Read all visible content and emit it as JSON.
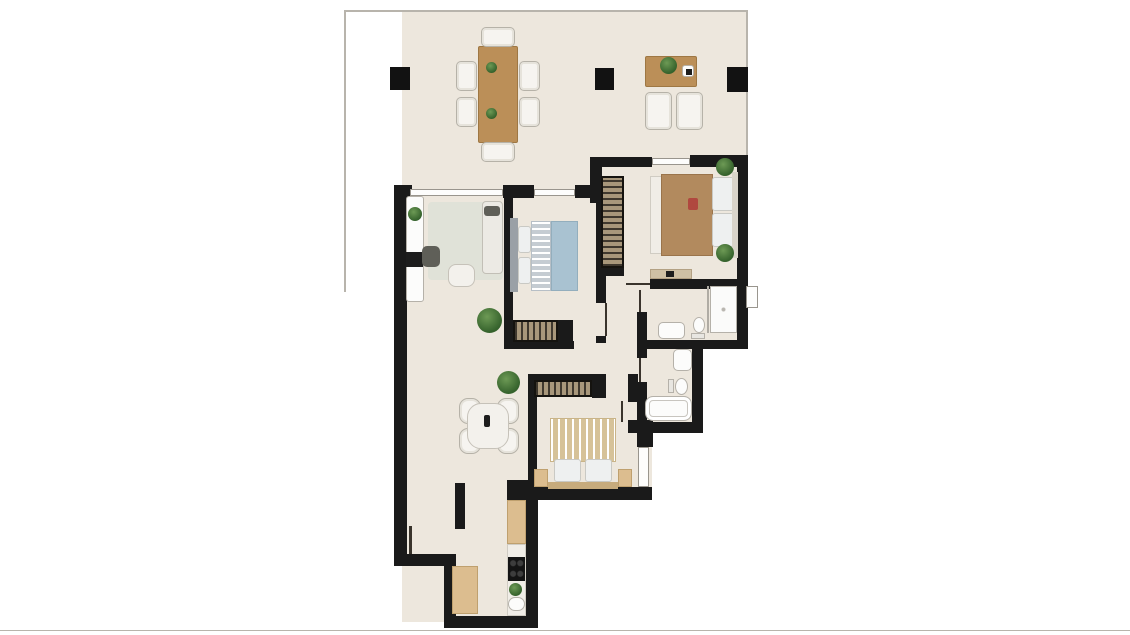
{
  "meta": {
    "type": "apartment-floorplan",
    "description": "Rendered 2-bedroom apartment floor plan with large top terrace, living room, two bedrooms, two bathrooms and galley kitchen. No text labels visible."
  },
  "palette": {
    "background": "#ffffff",
    "floor": "#ede7dd",
    "wall": "#1a1a1a",
    "wood": "#bb8f58",
    "plant_green": "#456f36",
    "bed_blue": "#a9c2d1",
    "bed_tan": "#b28a5e",
    "stripe_tan": "#d6c298"
  },
  "floorplan": {
    "floors": [
      {
        "name": "floor-terrace-left",
        "x": 402,
        "y": 12,
        "w": 200,
        "h": 176
      },
      {
        "name": "floor-terrace-right",
        "x": 602,
        "y": 12,
        "w": 146,
        "h": 146
      },
      {
        "name": "floor-living-kitchen",
        "x": 402,
        "y": 188,
        "w": 134,
        "h": 434
      },
      {
        "name": "floor-bedroom1-zone",
        "x": 505,
        "y": 188,
        "w": 100,
        "h": 305
      },
      {
        "name": "floor-hallway",
        "x": 596,
        "y": 197,
        "w": 41,
        "h": 290
      },
      {
        "name": "floor-master-bedroom",
        "x": 600,
        "y": 158,
        "w": 148,
        "h": 131
      },
      {
        "name": "floor-bathroom1",
        "x": 637,
        "y": 279,
        "w": 111,
        "h": 70
      },
      {
        "name": "floor-bathroom2",
        "x": 600,
        "y": 289,
        "w": 103,
        "h": 144
      },
      {
        "name": "floor-bedroom2-east",
        "x": 628,
        "y": 420,
        "w": 24,
        "h": 70
      }
    ],
    "boundary_lines": [
      {
        "name": "terrace-edge-top",
        "x": 344,
        "y": 10,
        "w": 404,
        "h": 2
      },
      {
        "name": "terrace-edge-left",
        "x": 344,
        "y": 10,
        "w": 2,
        "h": 282
      },
      {
        "name": "terrace-edge-right",
        "x": 746,
        "y": 10,
        "w": 2,
        "h": 148
      },
      {
        "name": "image-bottom-edge",
        "x": 0,
        "y": 630,
        "w": 1130,
        "h": 1
      }
    ],
    "pillars": [
      {
        "name": "pillar-terrace-left",
        "x": 390,
        "y": 67,
        "w": 20,
        "h": 23
      },
      {
        "name": "pillar-terrace-middle",
        "x": 595,
        "y": 68,
        "w": 19,
        "h": 22
      },
      {
        "name": "pillar-terrace-right",
        "x": 727,
        "y": 67,
        "w": 21,
        "h": 25
      }
    ],
    "walls": [
      {
        "name": "wall-exterior-left",
        "x": 394,
        "y": 185,
        "w": 13,
        "h": 381
      },
      {
        "name": "wall-step-bottom-left",
        "x": 394,
        "y": 554,
        "w": 62,
        "h": 12
      },
      {
        "name": "wall-kitchen-left",
        "x": 444,
        "y": 566,
        "w": 12,
        "h": 62
      },
      {
        "name": "wall-kitchen-bottom",
        "x": 444,
        "y": 616,
        "w": 94,
        "h": 12
      },
      {
        "name": "wall-kitchen-right",
        "x": 526,
        "y": 497,
        "w": 12,
        "h": 131
      },
      {
        "name": "wall-bedroom2-corner-block",
        "x": 507,
        "y": 480,
        "w": 21,
        "h": 20
      },
      {
        "name": "wall-bedroom2-bottom",
        "x": 522,
        "y": 487,
        "w": 130,
        "h": 13
      },
      {
        "name": "wall-se-step",
        "x": 637,
        "y": 420,
        "w": 16,
        "h": 27
      },
      {
        "name": "wall-bath2-bottom",
        "x": 637,
        "y": 422,
        "w": 66,
        "h": 11
      },
      {
        "name": "wall-bath2-right",
        "x": 692,
        "y": 340,
        "w": 11,
        "h": 93
      },
      {
        "name": "wall-bath-divider",
        "x": 637,
        "y": 340,
        "w": 111,
        "h": 9
      },
      {
        "name": "wall-exterior-right",
        "x": 737,
        "y": 155,
        "w": 11,
        "h": 194
      },
      {
        "name": "wall-master-top-right",
        "x": 690,
        "y": 155,
        "w": 58,
        "h": 12
      },
      {
        "name": "wall-master-top-left",
        "x": 590,
        "y": 157,
        "w": 62,
        "h": 10
      },
      {
        "name": "wall-terrace-step",
        "x": 590,
        "y": 157,
        "w": 12,
        "h": 46
      },
      {
        "name": "wall-living-top-corner",
        "x": 394,
        "y": 185,
        "w": 18,
        "h": 13
      },
      {
        "name": "wall-north-mid",
        "x": 503,
        "y": 185,
        "w": 31,
        "h": 13
      },
      {
        "name": "wall-north-right",
        "x": 575,
        "y": 185,
        "w": 27,
        "h": 13
      },
      {
        "name": "wall-bedroom1-left",
        "x": 504,
        "y": 187,
        "w": 9,
        "h": 160
      },
      {
        "name": "wall-bedroom1-bottom",
        "x": 504,
        "y": 341,
        "w": 70,
        "h": 8
      },
      {
        "name": "wall-bedroom1-wardrobe-cap",
        "x": 557,
        "y": 320,
        "w": 16,
        "h": 22
      },
      {
        "name": "wall-bedroom1-right",
        "x": 596,
        "y": 197,
        "w": 10,
        "h": 106
      },
      {
        "name": "wall-bedroom1-door-jamb",
        "x": 596,
        "y": 336,
        "w": 10,
        "h": 7
      },
      {
        "name": "wall-master-wardrobe-stub",
        "x": 600,
        "y": 267,
        "w": 24,
        "h": 9
      },
      {
        "name": "wall-master-bottom",
        "x": 650,
        "y": 279,
        "w": 98,
        "h": 10
      },
      {
        "name": "wall-bath1-left",
        "x": 637,
        "y": 312,
        "w": 10,
        "h": 28
      },
      {
        "name": "wall-bath2-left-stub",
        "x": 637,
        "y": 348,
        "w": 10,
        "h": 10
      },
      {
        "name": "wall-bath2-left",
        "x": 637,
        "y": 382,
        "w": 10,
        "h": 40
      },
      {
        "name": "wall-bedroom2-top",
        "x": 528,
        "y": 374,
        "w": 78,
        "h": 7
      },
      {
        "name": "wall-bedroom2-wardrobe-cap",
        "x": 592,
        "y": 374,
        "w": 14,
        "h": 24
      },
      {
        "name": "wall-bedroom2-left",
        "x": 528,
        "y": 374,
        "w": 9,
        "h": 119
      },
      {
        "name": "wall-bedroom2-right",
        "x": 628,
        "y": 374,
        "w": 10,
        "h": 28
      },
      {
        "name": "wall-bedroom2-right-stub",
        "x": 628,
        "y": 420,
        "w": 25,
        "h": 13
      },
      {
        "name": "wall-living-kitchen-partial",
        "x": 455,
        "y": 483,
        "w": 10,
        "h": 46
      }
    ],
    "windows": [
      {
        "name": "window-living-terrace",
        "x": 410,
        "y": 189,
        "w": 93,
        "h": 7
      },
      {
        "name": "window-bedroom1-terrace",
        "x": 534,
        "y": 189,
        "w": 41,
        "h": 7
      },
      {
        "name": "window-master-terrace",
        "x": 652,
        "y": 158,
        "w": 38,
        "h": 7
      },
      {
        "name": "window-shower-east",
        "x": 746,
        "y": 286,
        "w": 12,
        "h": 22
      },
      {
        "name": "window-bedroom2-east",
        "x": 638,
        "y": 447,
        "w": 11,
        "h": 40
      }
    ],
    "doors": [
      {
        "name": "door-bedroom1",
        "x": 605,
        "y": 303,
        "w": 2,
        "h": 33
      },
      {
        "name": "door-master-bedroom",
        "x": 626,
        "y": 283,
        "w": 24,
        "h": 2
      },
      {
        "name": "door-bathroom1",
        "x": 639,
        "y": 290,
        "w": 2,
        "h": 22
      },
      {
        "name": "door-bathroom2",
        "x": 639,
        "y": 358,
        "w": 2,
        "h": 24
      },
      {
        "name": "door-bedroom2",
        "x": 621,
        "y": 401,
        "w": 2,
        "h": 21
      },
      {
        "name": "door-living-west",
        "x": 409,
        "y": 526,
        "w": 3,
        "h": 28
      }
    ],
    "furniture": [
      {
        "name": "terrace-dining-table",
        "kind": "wood",
        "x": 478,
        "y": 46,
        "w": 40,
        "h": 97
      },
      {
        "name": "terrace-chair-top",
        "kind": "chair",
        "x": 481,
        "y": 27,
        "w": 34,
        "h": 20
      },
      {
        "name": "terrace-chair-bottom",
        "kind": "chair",
        "x": 481,
        "y": 142,
        "w": 34,
        "h": 20
      },
      {
        "name": "terrace-chair-left-1",
        "kind": "chair",
        "x": 456,
        "y": 61,
        "w": 21,
        "h": 30
      },
      {
        "name": "terrace-chair-left-2",
        "kind": "chair",
        "x": 456,
        "y": 97,
        "w": 21,
        "h": 30
      },
      {
        "name": "terrace-chair-right-1",
        "kind": "chair",
        "x": 519,
        "y": 61,
        "w": 21,
        "h": 30
      },
      {
        "name": "terrace-chair-right-2",
        "kind": "chair",
        "x": 519,
        "y": 97,
        "w": 21,
        "h": 30
      },
      {
        "name": "terrace-table-plant-1",
        "kind": "plant",
        "x": 486,
        "y": 62,
        "w": 11,
        "h": 11
      },
      {
        "name": "terrace-table-plant-2",
        "kind": "plant",
        "x": 486,
        "y": 108,
        "w": 11,
        "h": 11
      },
      {
        "name": "terrace-coffee-table",
        "kind": "wood",
        "x": 645,
        "y": 56,
        "w": 52,
        "h": 31
      },
      {
        "name": "terrace-coffee-table-plant",
        "kind": "plant",
        "x": 660,
        "y": 57,
        "w": 17,
        "h": 17
      },
      {
        "name": "terrace-coffee-table-tray",
        "kind": "fixture",
        "x": 682,
        "y": 65,
        "w": 12,
        "h": 12
      },
      {
        "name": "terrace-tray-item",
        "kind": "tv",
        "x": 686,
        "y": 69,
        "w": 6,
        "h": 6
      },
      {
        "name": "terrace-armchair-1",
        "kind": "chair",
        "x": 645,
        "y": 92,
        "w": 27,
        "h": 38
      },
      {
        "name": "terrace-armchair-2",
        "kind": "chair",
        "x": 676,
        "y": 92,
        "w": 27,
        "h": 38
      },
      {
        "name": "living-rug",
        "kind": "rug",
        "x": 428,
        "y": 202,
        "w": 75,
        "h": 78
      },
      {
        "name": "living-tv-sideboard",
        "kind": "fixture",
        "x": 406,
        "y": 196,
        "w": 18,
        "h": 106
      },
      {
        "name": "living-sideboard-plant",
        "kind": "plant",
        "x": 408,
        "y": 207,
        "w": 14,
        "h": 14
      },
      {
        "name": "living-tv",
        "kind": "tv",
        "x": 406,
        "y": 252,
        "w": 17,
        "h": 15
      },
      {
        "name": "living-sofa",
        "kind": "sofa",
        "x": 482,
        "y": 201,
        "w": 21,
        "h": 73
      },
      {
        "name": "living-sofa-cushion",
        "kind": "dark",
        "x": 484,
        "y": 206,
        "w": 16,
        "h": 10
      },
      {
        "name": "living-armchair",
        "kind": "dark",
        "x": 422,
        "y": 246,
        "w": 18,
        "h": 21,
        "r": 5
      },
      {
        "name": "living-coffee-table",
        "kind": "table-light",
        "x": 448,
        "y": 264,
        "w": 27,
        "h": 23
      },
      {
        "name": "living-plant",
        "kind": "plant",
        "x": 477,
        "y": 308,
        "w": 25,
        "h": 25
      },
      {
        "name": "dining-chair-1",
        "kind": "chair",
        "x": 459,
        "y": 398,
        "w": 22,
        "h": 26,
        "r": 9
      },
      {
        "name": "dining-chair-2",
        "kind": "chair",
        "x": 459,
        "y": 428,
        "w": 22,
        "h": 26,
        "r": 9
      },
      {
        "name": "dining-chair-3",
        "kind": "chair",
        "x": 497,
        "y": 398,
        "w": 22,
        "h": 26,
        "r": 9
      },
      {
        "name": "dining-chair-4",
        "kind": "chair",
        "x": 497,
        "y": 428,
        "w": 22,
        "h": 26,
        "r": 9
      },
      {
        "name": "dining-table",
        "kind": "table-light",
        "x": 467,
        "y": 403,
        "w": 42,
        "h": 46,
        "r": 14
      },
      {
        "name": "dining-table-decor",
        "kind": "tv",
        "x": 484,
        "y": 415,
        "w": 6,
        "h": 12,
        "r": 2
      },
      {
        "name": "dining-plant",
        "kind": "plant",
        "x": 497,
        "y": 371,
        "w": 23,
        "h": 23
      },
      {
        "name": "bedroom1-headboard",
        "kind": "hb",
        "x": 510,
        "y": 218,
        "w": 8,
        "h": 74
      },
      {
        "name": "bedroom1-pillow-1",
        "kind": "pillow",
        "x": 518,
        "y": 226,
        "w": 13,
        "h": 27
      },
      {
        "name": "bedroom1-pillow-2",
        "kind": "pillow",
        "x": 518,
        "y": 257,
        "w": 13,
        "h": 27
      },
      {
        "name": "bedroom1-bed-fold",
        "kind": "stripe-h",
        "x": 531,
        "y": 221,
        "w": 20,
        "h": 70
      },
      {
        "name": "bedroom1-duvet",
        "kind": "duvet-blue",
        "x": 551,
        "y": 221,
        "w": 27,
        "h": 70
      },
      {
        "name": "bedroom1-wardrobe",
        "kind": "wardrobe-h",
        "x": 513,
        "y": 320,
        "w": 45,
        "h": 22
      },
      {
        "name": "master-wardrobe",
        "kind": "wardrobe-v",
        "x": 601,
        "y": 176,
        "w": 23,
        "h": 92
      },
      {
        "name": "master-bed-foot-throw",
        "kind": "white",
        "x": 650,
        "y": 176,
        "w": 12,
        "h": 78
      },
      {
        "name": "master-duvet",
        "kind": "duvet-tan",
        "x": 661,
        "y": 174,
        "w": 52,
        "h": 82
      },
      {
        "name": "master-pillow-1",
        "kind": "pillow",
        "x": 712,
        "y": 177,
        "w": 22,
        "h": 34
      },
      {
        "name": "master-pillow-2",
        "kind": "pillow",
        "x": 712,
        "y": 213,
        "w": 22,
        "h": 34
      },
      {
        "name": "master-headboard",
        "kind": "hb",
        "x": 732,
        "y": 172,
        "w": 6,
        "h": 86,
        "fill": "#d9d4ca"
      },
      {
        "name": "master-nightstand-plant-1",
        "kind": "plant",
        "x": 716,
        "y": 158,
        "w": 18,
        "h": 18
      },
      {
        "name": "master-nightstand-plant-2",
        "kind": "plant",
        "x": 716,
        "y": 244,
        "w": 18,
        "h": 18
      },
      {
        "name": "master-accent-pillow",
        "kind": "accent-red",
        "x": 688,
        "y": 198,
        "w": 10,
        "h": 12
      },
      {
        "name": "master-console",
        "kind": "console",
        "x": 650,
        "y": 269,
        "w": 42,
        "h": 10
      },
      {
        "name": "master-console-decor",
        "kind": "tv",
        "x": 666,
        "y": 271,
        "w": 8,
        "h": 6
      },
      {
        "name": "bath1-shower-glass",
        "kind": "glass",
        "x": 707,
        "y": 286,
        "w": 2,
        "h": 47
      },
      {
        "name": "bath1-shower-tray",
        "kind": "shower",
        "x": 710,
        "y": 286,
        "w": 27,
        "h": 47
      },
      {
        "name": "bath1-sink",
        "kind": "fixture",
        "x": 658,
        "y": 322,
        "w": 27,
        "h": 17,
        "r": 5
      },
      {
        "name": "bath1-toilet-tank",
        "kind": "tank",
        "x": 691,
        "y": 333,
        "w": 14,
        "h": 6
      },
      {
        "name": "bath1-toilet-bowl",
        "kind": "toilet",
        "x": 693,
        "y": 317,
        "w": 12,
        "h": 16
      },
      {
        "name": "bath2-sink",
        "kind": "fixture",
        "x": 673,
        "y": 349,
        "w": 19,
        "h": 22,
        "r": 5
      },
      {
        "name": "bath2-toilet-tank",
        "kind": "tank",
        "x": 668,
        "y": 379,
        "w": 6,
        "h": 14
      },
      {
        "name": "bath2-toilet-bowl",
        "kind": "toilet",
        "x": 675,
        "y": 378,
        "w": 13,
        "h": 17
      },
      {
        "name": "bath2-bathtub",
        "kind": "tub",
        "x": 645,
        "y": 396,
        "w": 47,
        "h": 25
      },
      {
        "name": "bedroom2-duvet",
        "kind": "stripe-v",
        "x": 550,
        "y": 418,
        "w": 66,
        "h": 44
      },
      {
        "name": "bedroom2-pillow-1",
        "kind": "pillow",
        "x": 554,
        "y": 459,
        "w": 27,
        "h": 23
      },
      {
        "name": "bedroom2-pillow-2",
        "kind": "pillow",
        "x": 585,
        "y": 459,
        "w": 27,
        "h": 23
      },
      {
        "name": "bedroom2-headboard",
        "kind": "hb",
        "x": 548,
        "y": 482,
        "w": 70,
        "h": 7,
        "fill": "#c7ab7c"
      },
      {
        "name": "bedroom2-nightstand-1",
        "kind": "counter",
        "x": 534,
        "y": 469,
        "w": 14,
        "h": 18
      },
      {
        "name": "bedroom2-nightstand-2",
        "kind": "counter",
        "x": 618,
        "y": 469,
        "w": 14,
        "h": 18
      },
      {
        "name": "bedroom2-wardrobe",
        "kind": "wardrobe-h",
        "x": 534,
        "y": 380,
        "w": 58,
        "h": 17
      },
      {
        "name": "kitchen-counter-west",
        "kind": "counter",
        "x": 452,
        "y": 566,
        "w": 26,
        "h": 48
      },
      {
        "name": "kitchen-counter-east-upper",
        "kind": "counter",
        "x": 507,
        "y": 500,
        "w": 19,
        "h": 44
      },
      {
        "name": "kitchen-worktop-east",
        "kind": "white",
        "x": 507,
        "y": 544,
        "w": 19,
        "h": 72
      },
      {
        "name": "kitchen-stove",
        "kind": "stove",
        "x": 508,
        "y": 557,
        "w": 17,
        "h": 24
      },
      {
        "name": "kitchen-plant",
        "kind": "plant",
        "x": 509,
        "y": 583,
        "w": 13,
        "h": 13
      },
      {
        "name": "kitchen-sink",
        "kind": "fixture",
        "x": 508,
        "y": 597,
        "w": 17,
        "h": 14,
        "r": 7
      }
    ]
  }
}
